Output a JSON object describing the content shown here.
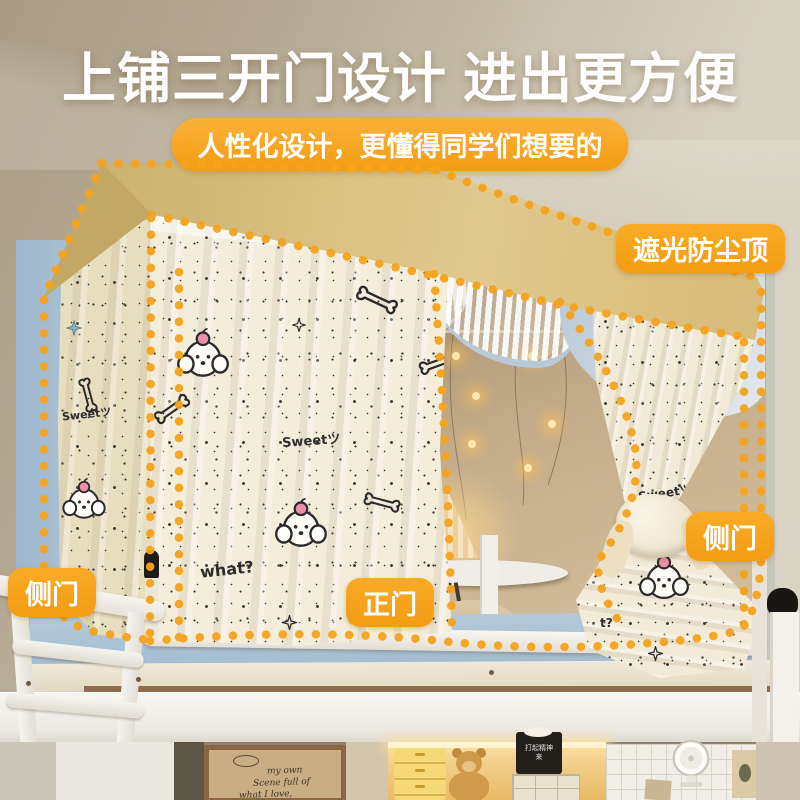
{
  "header": {
    "title": "上铺三开门设计 进出更方便",
    "subtitle": "人性化设计，更懂得同学们想要的"
  },
  "annotations": {
    "roof_label": "遮光防尘顶",
    "side_door_label": "侧门",
    "front_door_label": "正门"
  },
  "curtain_prints": {
    "sweet": "Sweetツ",
    "what": "what?",
    "t": "t?"
  },
  "poster": {
    "line1": "my own",
    "line2": "Scene full of",
    "line3": "what I love,"
  },
  "shelf_sign": {
    "line1": "打起精神",
    "line2": "来"
  },
  "colors": {
    "accent_orange": "#F7A41D",
    "dotted_line": "#F7A31C",
    "canopy_khaki": "#DCC386",
    "trim_blue": "#B6C7D6"
  }
}
